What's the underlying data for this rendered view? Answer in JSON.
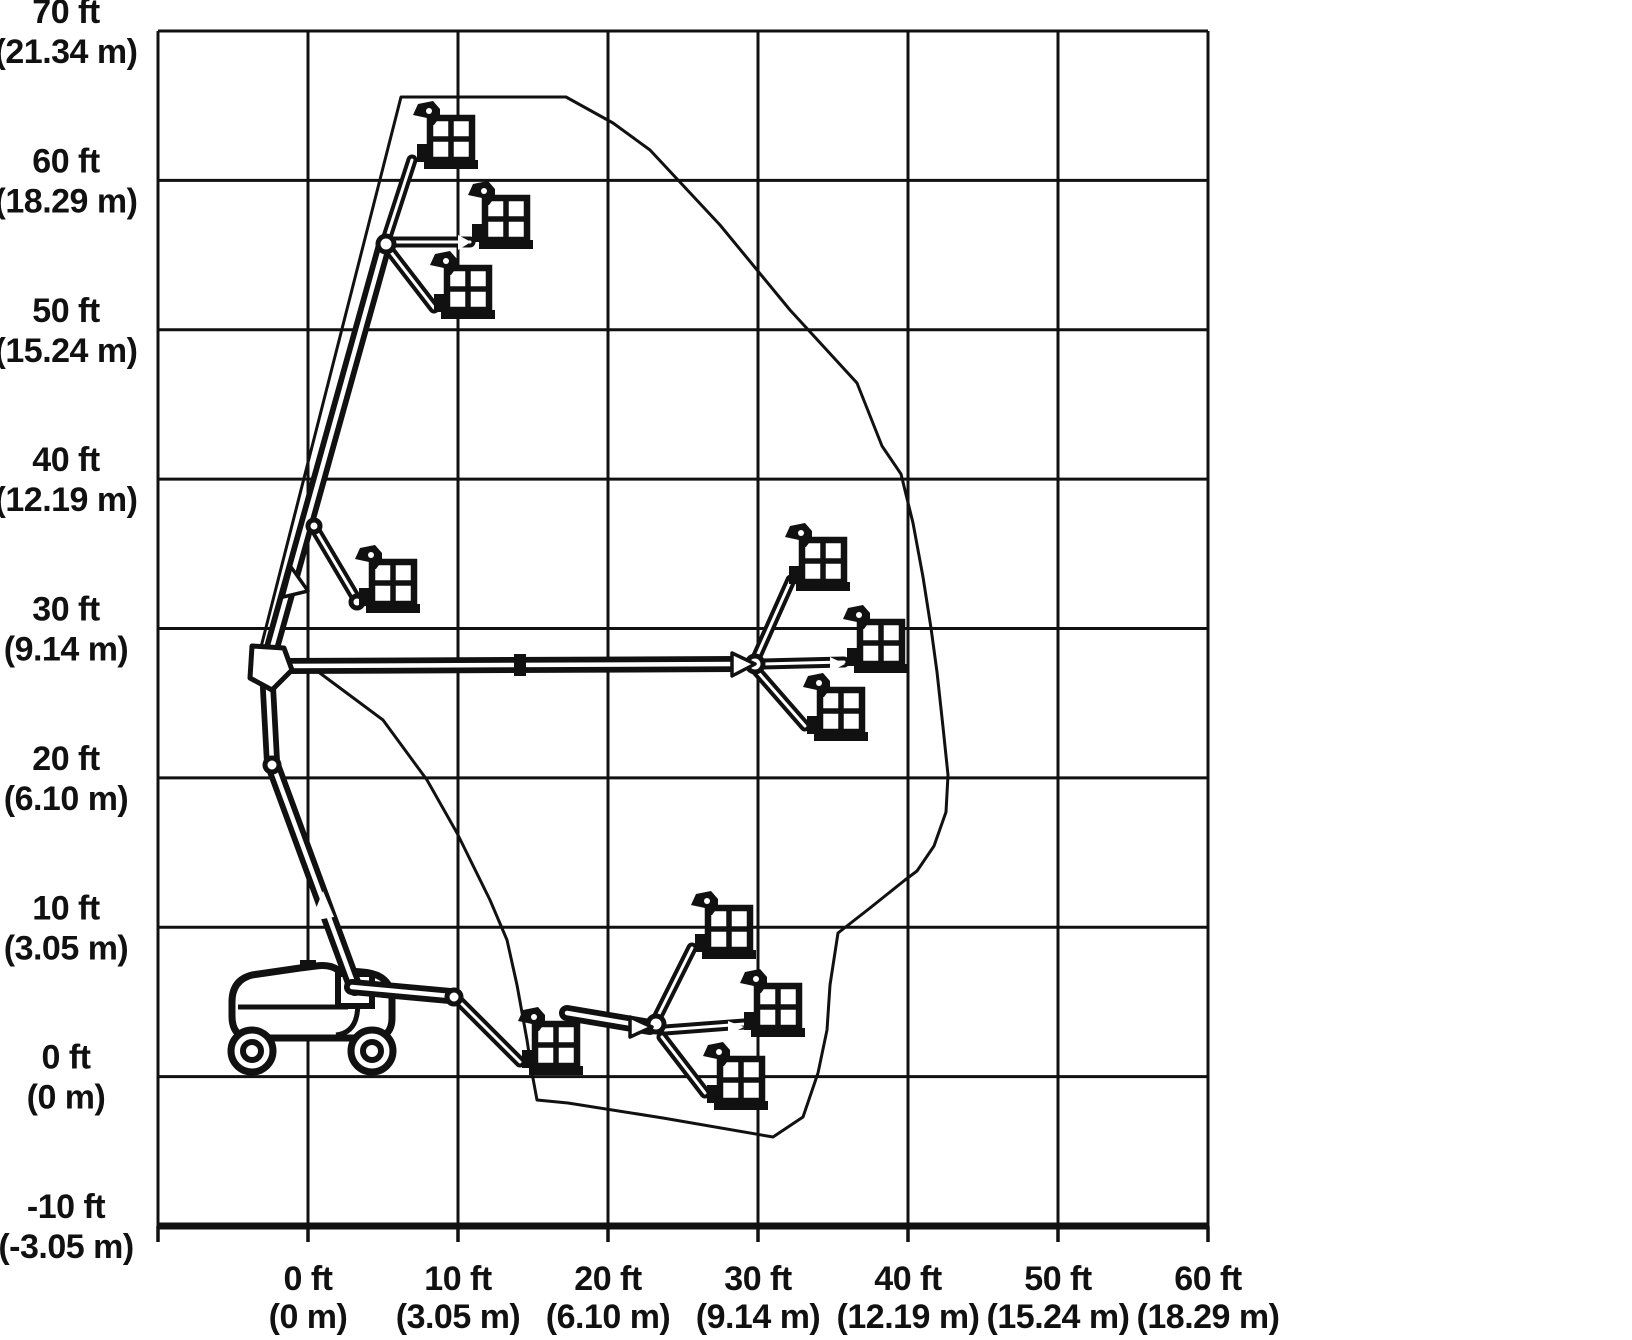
{
  "page": {
    "background": "#ffffff",
    "ink": "#111111",
    "description": "Articulating boom lift range of motion working envelope diagram"
  },
  "chart_data": {
    "type": "area",
    "title": "Boom lift working envelope (range of motion)",
    "xlabel": "Horizontal reach",
    "ylabel": "Platform height",
    "x_axis": {
      "ticks_ft": [
        "0 ft",
        "10 ft",
        "20 ft",
        "30 ft",
        "40 ft",
        "50 ft",
        "60 ft"
      ],
      "ticks_m": [
        "(0 m)",
        "(3.05 m)",
        "(6.10 m)",
        "(9.14 m)",
        "(12.19 m)",
        "(15.24 m)",
        "(18.29 m)"
      ],
      "range_ft": [
        -10,
        60
      ],
      "grid": true
    },
    "y_axis": {
      "ticks_ft": [
        "70 ft",
        "60 ft",
        "50 ft",
        "40 ft",
        "30 ft",
        "20 ft",
        "10 ft",
        "0 ft",
        "-10 ft"
      ],
      "ticks_m": [
        "(21.34 m)",
        "(18.29 m)",
        "(15.24 m)",
        "(12.19 m)",
        "(9.14 m)",
        "(6.10 m)",
        "(3.05 m)",
        "(0 m)",
        "(-3.05 m)"
      ],
      "range_ft": [
        -10,
        70
      ],
      "grid": true
    },
    "envelope_ft": [
      [
        6.2,
        65.5
      ],
      [
        17.2,
        65.5
      ],
      [
        20.3,
        63.8
      ],
      [
        22.8,
        62.0
      ],
      [
        27.5,
        57.0
      ],
      [
        32.1,
        51.3
      ],
      [
        36.6,
        46.4
      ],
      [
        38.3,
        42.2
      ],
      [
        39.5,
        40.3
      ],
      [
        40.3,
        37.0
      ],
      [
        41.0,
        33.4
      ],
      [
        41.5,
        30.0
      ],
      [
        41.9,
        27.0
      ],
      [
        42.3,
        23.4
      ],
      [
        42.7,
        20.2
      ],
      [
        42.5,
        17.7
      ],
      [
        41.7,
        15.4
      ],
      [
        40.6,
        13.7
      ],
      [
        39.8,
        13.1
      ],
      [
        37.5,
        11.2
      ],
      [
        35.3,
        9.6
      ],
      [
        34.8,
        6.1
      ],
      [
        34.6,
        3.1
      ],
      [
        34.0,
        0.2
      ],
      [
        33.0,
        -2.7
      ],
      [
        31.0,
        -4.1
      ],
      [
        23.7,
        -2.8
      ],
      [
        17.3,
        -1.8
      ],
      [
        15.3,
        -1.6
      ],
      [
        14.9,
        0.2
      ],
      [
        14.6,
        2.4
      ],
      [
        13.9,
        6.1
      ],
      [
        13.3,
        9.1
      ],
      [
        12.1,
        11.8
      ],
      [
        9.9,
        16.3
      ],
      [
        7.9,
        19.8
      ],
      [
        5.0,
        23.8
      ],
      [
        2.1,
        26.0
      ],
      [
        -0.2,
        27.7
      ],
      [
        -3.3,
        28.2
      ]
    ],
    "platform_positions_ft": [
      [
        9.5,
        62.5
      ],
      [
        13.2,
        57.2
      ],
      [
        10.7,
        52.5
      ],
      [
        5.7,
        32.8
      ],
      [
        34.3,
        34.3
      ],
      [
        38.2,
        28.8
      ],
      [
        35.5,
        24.2
      ],
      [
        16.5,
        1.9
      ],
      [
        28.1,
        9.6
      ],
      [
        31.3,
        4.4
      ],
      [
        28.9,
        -0.5
      ]
    ]
  },
  "axes": {
    "y_ticks": [
      {
        "ft": "70 ft",
        "m": "(21.34 m)"
      },
      {
        "ft": "60 ft",
        "m": "(18.29 m)"
      },
      {
        "ft": "50 ft",
        "m": "(15.24 m)"
      },
      {
        "ft": "40 ft",
        "m": "(12.19 m)"
      },
      {
        "ft": "30 ft",
        "m": "(9.14 m)"
      },
      {
        "ft": "20 ft",
        "m": "(6.10 m)"
      },
      {
        "ft": "10 ft",
        "m": "(3.05 m)"
      },
      {
        "ft": "0 ft",
        "m": "(0 m)"
      },
      {
        "ft": "-10 ft",
        "m": "(-3.05 m)"
      }
    ],
    "x_ticks": [
      {
        "ft": "0 ft",
        "m": "(0 m)"
      },
      {
        "ft": "10 ft",
        "m": "(3.05 m)"
      },
      {
        "ft": "20 ft",
        "m": "(6.10 m)"
      },
      {
        "ft": "30 ft",
        "m": "(9.14 m)"
      },
      {
        "ft": "40 ft",
        "m": "(12.19 m)"
      },
      {
        "ft": "50 ft",
        "m": "(15.24 m)"
      },
      {
        "ft": "60 ft",
        "m": "(18.29 m)"
      }
    ]
  },
  "drawing": {
    "grid": {
      "x0": 158,
      "xstep": 150,
      "xcount": 8,
      "y0": 31,
      "ystep": 149.375,
      "ycount": 9
    },
    "label_geom": {
      "y_label_x": 66,
      "y_dy1": -8,
      "y_dy2": 32,
      "x_base1": 1290,
      "x_base2": 1328,
      "font": 34
    },
    "envelope_px": [
      [
        401,
        97
      ],
      [
        566,
        97
      ],
      [
        613,
        123
      ],
      [
        650,
        150
      ],
      [
        720,
        225
      ],
      [
        790,
        310
      ],
      [
        857,
        383
      ],
      [
        882,
        446
      ],
      [
        901,
        474
      ],
      [
        913,
        523
      ],
      [
        923,
        577
      ],
      [
        931,
        628
      ],
      [
        937,
        672
      ],
      [
        943,
        727
      ],
      [
        948,
        775
      ],
      [
        946,
        812
      ],
      [
        934,
        846
      ],
      [
        917,
        871
      ],
      [
        905,
        880
      ],
      [
        870,
        908
      ],
      [
        838,
        933
      ],
      [
        830,
        985
      ],
      [
        827,
        1030
      ],
      [
        818,
        1073
      ],
      [
        803,
        1117
      ],
      [
        773,
        1137
      ],
      [
        663,
        1118
      ],
      [
        568,
        1103
      ],
      [
        537,
        1100
      ],
      [
        532,
        1073
      ],
      [
        527,
        1040
      ],
      [
        517,
        985
      ],
      [
        507,
        940
      ],
      [
        490,
        900
      ],
      [
        457,
        833
      ],
      [
        427,
        780
      ],
      [
        383,
        720
      ],
      [
        340,
        688
      ],
      [
        305,
        662
      ],
      [
        259,
        655
      ]
    ],
    "booms": [
      {
        "name": "riser-arm-lower",
        "x1": 274,
        "y1": 768,
        "x2": 355,
        "y2": 988
      },
      {
        "name": "riser-arm-upper",
        "x1": 268,
        "y1": 688,
        "x2": 272,
        "y2": 762
      },
      {
        "name": "main-boom-raised",
        "x1": 268,
        "y1": 662,
        "x2": 385,
        "y2": 242
      },
      {
        "name": "main-boom-horizontal",
        "x1": 284,
        "y1": 666,
        "x2": 737,
        "y2": 664
      },
      {
        "name": "main-boom-low",
        "x1": 352,
        "y1": 987,
        "x2": 450,
        "y2": 996
      },
      {
        "name": "main-boom-low-extended",
        "x1": 567,
        "y1": 1013,
        "x2": 650,
        "y2": 1027
      }
    ],
    "jibs": [
      {
        "name": "jib-mid-height",
        "x1": 312,
        "y1": 524,
        "x2": 357,
        "y2": 600
      },
      {
        "name": "jib-top-up",
        "x1": 386,
        "y1": 240,
        "x2": 412,
        "y2": 160
      },
      {
        "name": "jib-top-level",
        "x1": 388,
        "y1": 242,
        "x2": 470,
        "y2": 242
      },
      {
        "name": "jib-top-down",
        "x1": 387,
        "y1": 247,
        "x2": 434,
        "y2": 308
      },
      {
        "name": "jib-outreach-up",
        "x1": 757,
        "y1": 656,
        "x2": 791,
        "y2": 580
      },
      {
        "name": "jib-outreach-level",
        "x1": 760,
        "y1": 664,
        "x2": 844,
        "y2": 662
      },
      {
        "name": "jib-outreach-down",
        "x1": 757,
        "y1": 671,
        "x2": 805,
        "y2": 726
      },
      {
        "name": "jib-low-up",
        "x1": 658,
        "y1": 1016,
        "x2": 692,
        "y2": 948
      },
      {
        "name": "jib-low-level",
        "x1": 665,
        "y1": 1030,
        "x2": 744,
        "y2": 1024
      },
      {
        "name": "jib-low-down",
        "x1": 662,
        "y1": 1037,
        "x2": 705,
        "y2": 1093
      },
      {
        "name": "jib-droop",
        "x1": 457,
        "y1": 999,
        "x2": 520,
        "y2": 1062
      }
    ],
    "joints": [
      [
        386,
        244,
        8
      ],
      [
        755,
        664,
        8
      ],
      [
        656,
        1024,
        8
      ],
      [
        454,
        997,
        7
      ],
      [
        314,
        526,
        6
      ],
      [
        272,
        765,
        7
      ],
      [
        357,
        602,
        6
      ]
    ],
    "turret_pentagon": "252,646 284,648 292,670 272,690 250,678",
    "arrows": [
      {
        "pts": "732,653 755,664 732,676",
        "outlined": true
      },
      {
        "pts": "630,1017 652,1027 630,1037",
        "outlined": true
      },
      {
        "pts": "283,597 291,567 308,591",
        "outlined": true
      },
      {
        "pts": "311,921 323,891 334,917",
        "outlined": false
      },
      {
        "pts": "458,235 471,242 458,250",
        "outlined": false
      },
      {
        "pts": "830,657 845,664 830,672",
        "outlined": false
      },
      {
        "pts": "728,1021 744,1027 728,1035",
        "outlined": false
      }
    ],
    "collar": [
      514,
      654,
      12,
      22
    ],
    "baskets": [
      {
        "name": "platform-full-height-jib-up",
        "x": 430,
        "y": 118
      },
      {
        "name": "platform-full-height-jib-level",
        "x": 485,
        "y": 198
      },
      {
        "name": "platform-full-height-jib-down",
        "x": 447,
        "y": 268
      },
      {
        "name": "platform-mid-height",
        "x": 372,
        "y": 562
      },
      {
        "name": "platform-max-outreach-jib-up",
        "x": 802,
        "y": 540
      },
      {
        "name": "platform-max-outreach-jib-level",
        "x": 860,
        "y": 622
      },
      {
        "name": "platform-max-outreach-jib-down",
        "x": 820,
        "y": 690
      },
      {
        "name": "platform-low-close",
        "x": 535,
        "y": 1024
      },
      {
        "name": "platform-below-grade-jib-up",
        "x": 708,
        "y": 908
      },
      {
        "name": "platform-below-grade-jib-level",
        "x": 757,
        "y": 986
      },
      {
        "name": "platform-below-grade-jib-down",
        "x": 720,
        "y": 1059
      }
    ],
    "machine": {
      "body": "M 232 1002 Q 232 980 252 975 L 300 968 L 316 966 Q 330 964 338 970 L 362 972 Q 392 974 392 1000 L 392 1018 Q 392 1038 372 1038 L 252 1038 Q 232 1038 232 1016 Z",
      "accent1": "M 238 1007 L 348 1007",
      "accent2": "M 336 974 Q 362 986 357 1014 Q 354 1033 336 1035",
      "nub": [
        300,
        960,
        16,
        9
      ],
      "turntable": [
        338,
        974,
        34,
        32
      ],
      "wheels": [
        [
          252,
          1051
        ],
        [
          372,
          1051
        ]
      ],
      "wheel_r_outer": 21,
      "wheel_r_inner": 9
    }
  }
}
